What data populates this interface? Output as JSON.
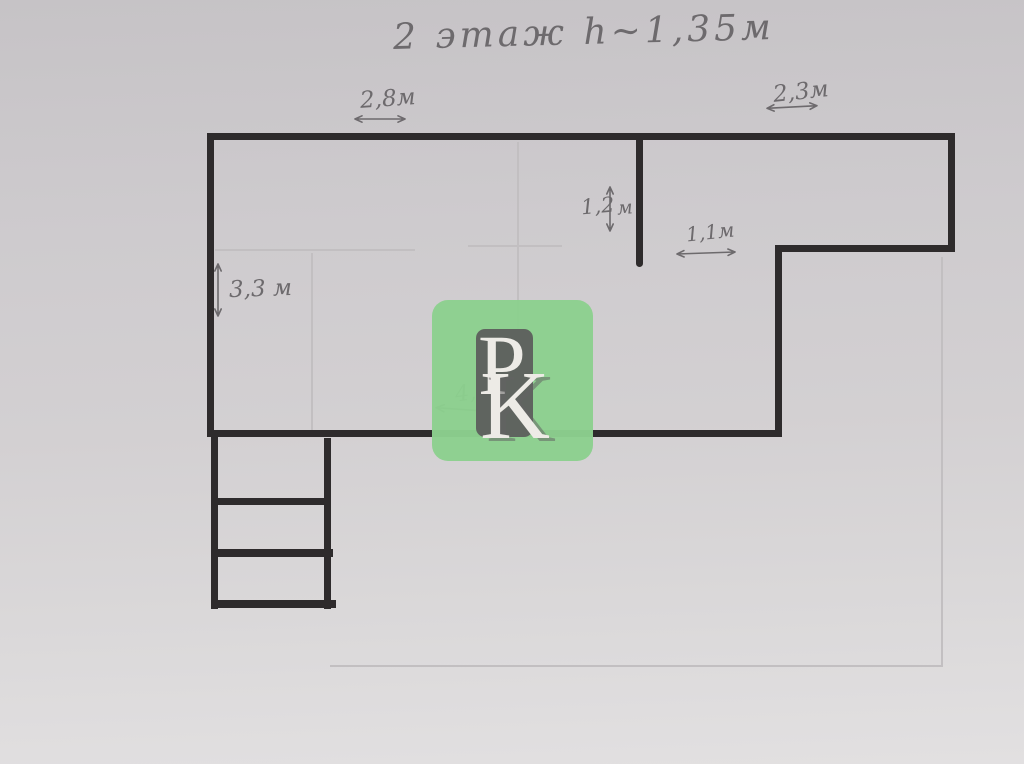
{
  "title": "2 этаж h~1,35м",
  "dims": {
    "w28": {
      "label": "2,8м"
    },
    "w23": {
      "label": "2,3м"
    },
    "h12": {
      "num": "1,2",
      "unit": "м"
    },
    "w11": {
      "label": "1,1м"
    },
    "h33": {
      "label": "3,3 м"
    },
    "w41": {
      "label": "4,1м"
    }
  },
  "watermark": {
    "p": "P",
    "k": "K"
  },
  "colors": {
    "wall": "#2e2b2c",
    "pencil": "#6d6a6d",
    "faint": "#c2bfc1",
    "wm-green": "#8cd08e",
    "wm-gray": "#5b5b5b",
    "wm-letter": "#edebe6"
  }
}
